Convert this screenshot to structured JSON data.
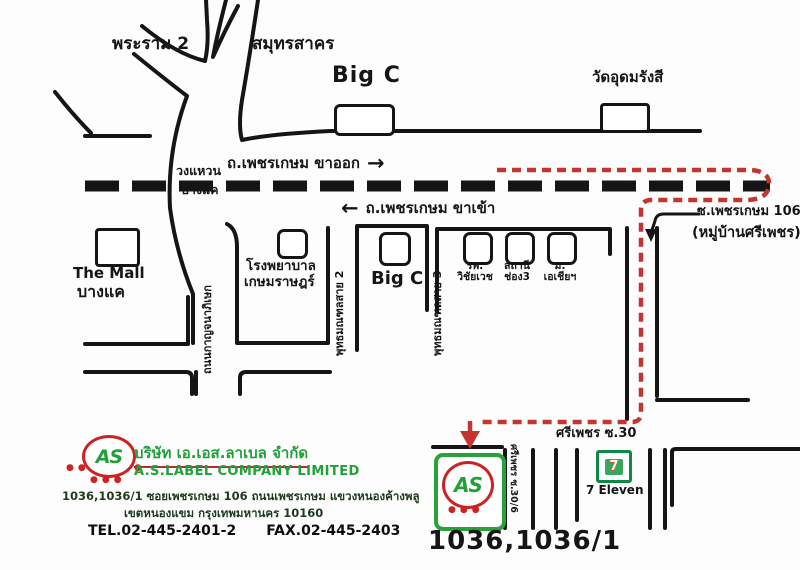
{
  "map": {
    "north": {
      "rama2": "พระราม 2",
      "samut_sakhon": "สมุทรสาคร",
      "big_c": "Big C",
      "wat": "วัดอุดมรังสี"
    },
    "phetkasem": {
      "outbound": "ถ.เพชรเกษม ขาออก",
      "inbound": "ถ.เพชรเกษม ขาเข้า",
      "ring_line1": "วงแหวน",
      "ring_line2": "บางแค",
      "ring_road_name": "ถนนกาญจนาภิเษก"
    },
    "south": {
      "mall_line1": "The Mall",
      "mall_line2": "บางแค",
      "hospital_line1": "โรงพยาบาล",
      "hospital_line2": "เกษมราษฎร์",
      "sai2": "พุทธมณฑลสาย 2",
      "big_c": "Big C",
      "sai3": "พุทธมณฑลสาย 3",
      "landmarks": [
        {
          "line1": "รพ.",
          "line2": "วิชัยเวช"
        },
        {
          "line1": "สถานี",
          "line2": "ช่อง3"
        },
        {
          "line1": "ม.",
          "line2": "เอเชียฯ"
        }
      ]
    },
    "soi106": {
      "label": "ซ.เพชรเกษม 106",
      "village": "(หมู่บ้านศรีเพชร)"
    },
    "destination": {
      "street": "ศรีเพชร ซ.30",
      "soi_vertical": "ศรีเพชร ซ.30/6",
      "seven_eleven": "7 Eleven",
      "seven_logo": "7",
      "house_no": "1036,1036/1",
      "logo_text": "AS"
    }
  },
  "company": {
    "logo_text": "AS",
    "name_th": "บริษัท เอ.เอส.ลาเบล จำกัด",
    "name_en": "A.S.LABEL COMPANY LIMITED",
    "addr1": "1036,1036/1 ซอยเพชรเกษม 106 ถนนเพชรเกษม แขวงหนองค้างพลู",
    "addr2": "เขตหนองแขม กรุงเทพมหานคร 10160",
    "tel": "TEL.02-445-2401-2",
    "fax": "FAX.02-445-2403"
  },
  "icons": {
    "arrow_right": "→",
    "arrow_left": "←"
  },
  "colors": {
    "route_red": "#c43530",
    "brand_green": "#21a038",
    "brand_red": "#cc2222",
    "seven_green": "#0c8a44",
    "road_black": "#151515"
  }
}
